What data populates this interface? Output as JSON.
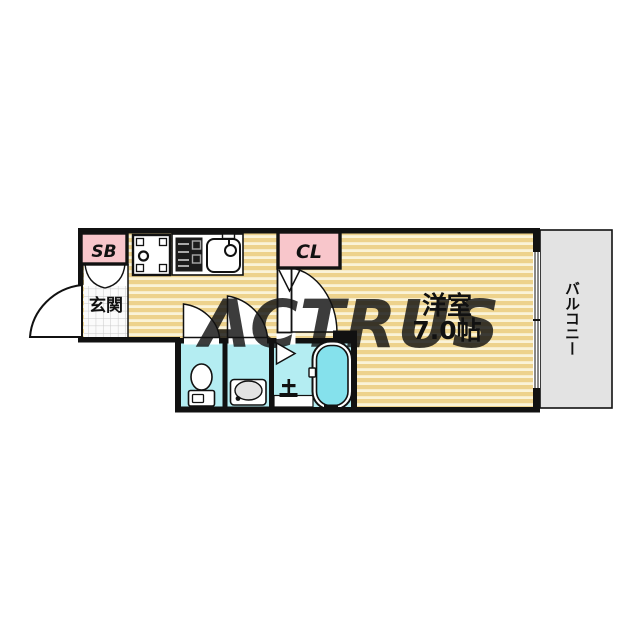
{
  "plan": {
    "type": "apartment-floorplan",
    "watermark": "ACTRUS",
    "labels": {
      "shoe_box": "SB",
      "entrance": "玄関",
      "closet": "CL",
      "main_room_name": "洋室",
      "main_room_size": "7.0帖",
      "balcony": "バルコニー"
    },
    "colors": {
      "wall": "#111111",
      "floor_tan": "#edd28c",
      "floor_stripe": "#faf3d8",
      "label_pink": "#f8c6cb",
      "wet_area_cyan": "#b4edf2",
      "bathtub_cyan": "#85e1ec",
      "basin_gray": "#e3e3e3",
      "balcony_gray": "#e3e3e3",
      "watermark_cream": "#f1ead3",
      "tile_line": "#c9c9c9"
    },
    "fixtures": [
      "washing-machine-pan",
      "gas-stove",
      "kitchen-sink",
      "toilet",
      "washbasin",
      "bathtub",
      "shower-faucet"
    ]
  }
}
